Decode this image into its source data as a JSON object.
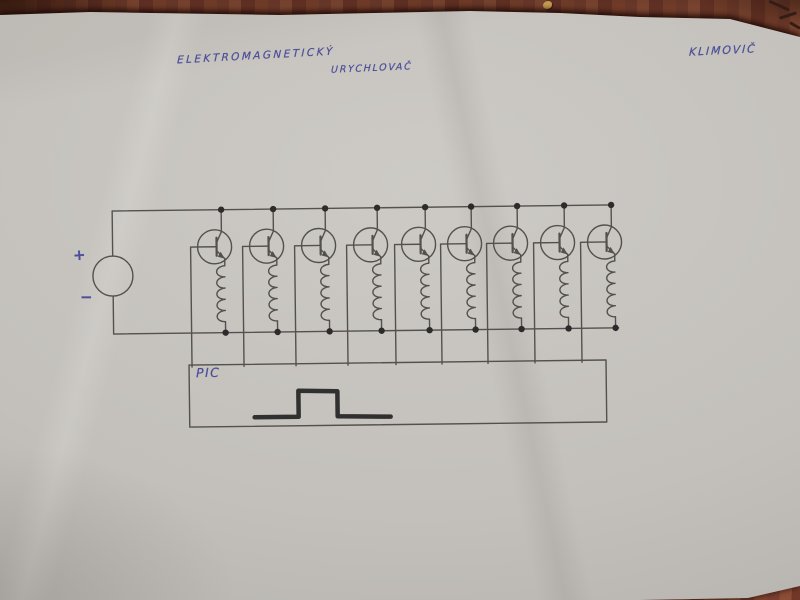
{
  "photo": {
    "colors": {
      "wood": "#7c432f",
      "wood_dark": "#35190f",
      "paper": "#c3c0bb",
      "paper_light": "#cdcac5",
      "paper_dark": "#aeaba6",
      "ink": "#4d4f99",
      "line": "#4a4744",
      "dot": "#1f1f1f",
      "pulse": "#242424",
      "speck": "#c49a4f"
    }
  },
  "handwriting": {
    "title_word1": "ELEKTROMAGNETICKÝ",
    "title_word2": "URYCHLOVAČ",
    "author": "KLIMOVIČ",
    "pic_label": "PIC",
    "plus": "+",
    "minus": "−"
  },
  "circuit": {
    "kind": "multi-stage electromagnetic accelerator (coilgun) driver schematic",
    "description": "DC source feeding a top and bottom supply bus; 9 identical stages each with an NPN transistor switching a coil; transistor bases driven by lines from a PIC microcontroller box that outputs a pulse",
    "stage_count": 9,
    "tilt_deg": -0.7,
    "stages_x": [
      222,
      274,
      326,
      378,
      426,
      472,
      518,
      565,
      612
    ],
    "bus_top_y": 208,
    "bus_bottom_y": 331,
    "bus_left_x": 113,
    "source": {
      "cx": 113,
      "cy": 273,
      "r": 20
    },
    "transistor": {
      "dx": -7,
      "cy": 245,
      "r": 17
    },
    "coil": {
      "dx": 3,
      "top_y": 264,
      "bottom_y": 320,
      "loops": 5
    },
    "base_dx": -31,
    "dot_r": 3.2,
    "line_width": 1.4,
    "pic_box": {
      "x": 188,
      "y": 363,
      "w": 417,
      "h": 62
    },
    "pulse_points": [
      [
        253,
        416
      ],
      [
        297,
        416
      ],
      [
        297,
        390
      ],
      [
        336,
        391
      ],
      [
        336,
        416
      ],
      [
        389,
        417
      ]
    ],
    "pulse_width": 4.5
  }
}
